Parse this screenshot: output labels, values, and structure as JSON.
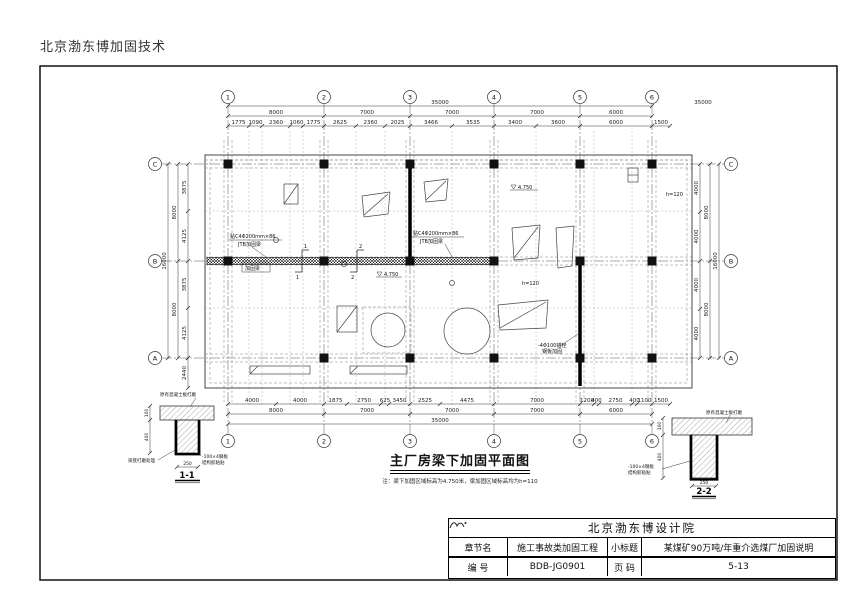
{
  "header": {
    "company_top": "北京渤东博加固技术"
  },
  "drawing": {
    "title": "主厂房梁下加固平面图",
    "note": "注：梁下加固区域标高为4.750米，梁加固区域标高均为h=110",
    "grid": {
      "cols": [
        "1",
        "2",
        "3",
        "4",
        "5",
        "6"
      ],
      "rows": [
        "C",
        "B",
        "A"
      ]
    },
    "dims": {
      "top_overall": "35000",
      "top_spans": [
        "8000",
        "7000",
        "7000",
        "7000",
        "6000"
      ],
      "top_sub": [
        "1775",
        "1090",
        "2360",
        "1060",
        "1775",
        "2625",
        "2360",
        "2025",
        "3466",
        "3535",
        "3400",
        "3600",
        "6000",
        "1500"
      ],
      "bottom_overall": "35000",
      "bottom_spans": [
        "8000",
        "7000",
        "7000",
        "7000",
        "6000"
      ],
      "bottom_sub": [
        "4000",
        "4000",
        "1875",
        "2750",
        "625",
        "3450",
        "2525",
        "4475",
        "7000",
        "1200",
        "400",
        "2750",
        "400",
        "1100",
        "1500"
      ],
      "left_overall": "16000",
      "left_spans": [
        "8000",
        "8000"
      ],
      "left_sub": [
        "3875",
        "4125",
        "3875",
        "4125"
      ],
      "left_below": "2440",
      "right_overall": "16000",
      "right_spans": [
        "8000",
        "8000"
      ],
      "right_sub": [
        "4000",
        "4000",
        "4000",
        "4000"
      ]
    },
    "annotations": {
      "elev1": "4.750",
      "elev2": "4.750",
      "h1": "h=120",
      "h2": "h=120",
      "beam_note1a": "贴C4Φ200mm×86",
      "beam_note1b": "JTB加固梁",
      "beam_note2a": "贴C4Φ200mm×86",
      "beam_note2b": "JTB加固梁",
      "anchor_note_a": "-4Φ100锚栓",
      "anchor_note_b": "钢板加固",
      "beam_box": "加固梁",
      "section1": "1",
      "section2": "2"
    }
  },
  "details": {
    "d1": {
      "label": "1-1",
      "top_note": "原有混凝土板打磨",
      "side_note1": "-100×4钢板",
      "side_note2": "结构胶粘贴",
      "bottom_note": "梁底打磨处理",
      "dim_left1": "100",
      "dim_left2": "400",
      "dim_bottom": "250"
    },
    "d2": {
      "label": "2-2",
      "top_note": "原有混凝土板打磨",
      "side_note1": "-100×4钢板",
      "side_note2": "结构胶粘贴",
      "dim_left1": "100",
      "dim_left2": "400",
      "dim_bottom": "250"
    }
  },
  "titleblock": {
    "company": "北京渤东博设计院",
    "rows": [
      {
        "k1": "章节名",
        "v1": "施工事故类加固工程",
        "k2": "小标题",
        "v2": "某煤矿90万吨/年重介选煤厂加固说明"
      },
      {
        "k1": "编  号",
        "v1": "BDB-JG0901",
        "k2": "页  码",
        "v2": "5-13"
      }
    ]
  }
}
